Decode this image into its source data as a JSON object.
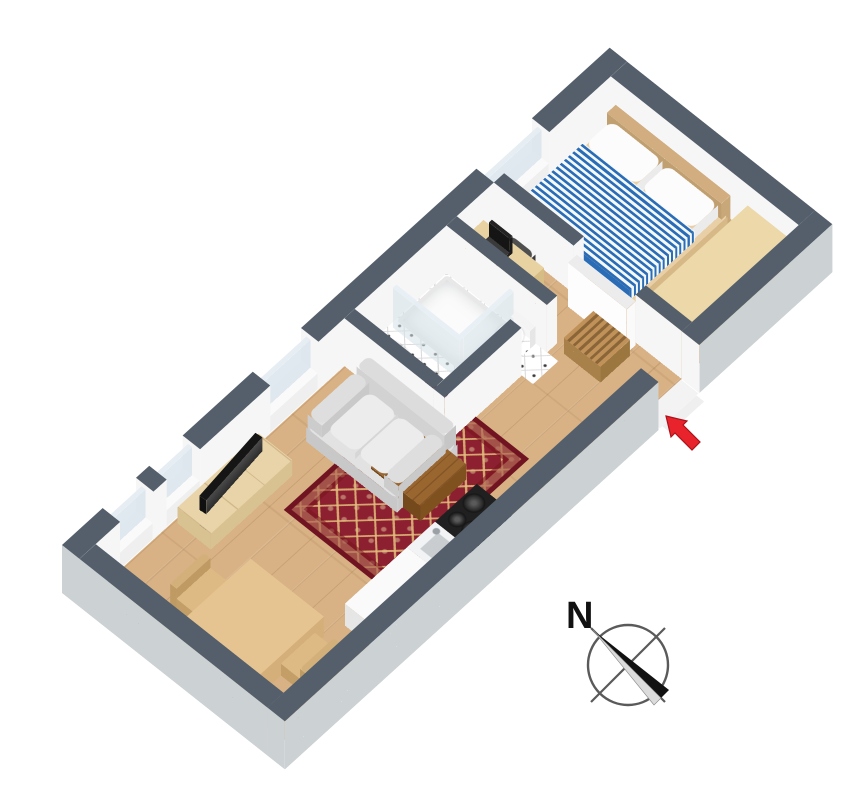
{
  "page": {
    "background": "#ffffff",
    "type": "3d-floor-plan-render"
  },
  "compass": {
    "label": "N",
    "icon": "compass-rose-icon",
    "needle_dark": "#111111",
    "needle_light": "#dcdcdc",
    "ring_color": "#5a5a5a"
  },
  "entrance": {
    "icon": "red-arrow-icon",
    "meaning": "entrance-marker",
    "color": "#e8232b"
  },
  "palette": {
    "wall_top": "#545f6b",
    "wall_side_interior": "#f6f6f6",
    "wall_side_exterior": "#ccd1d4",
    "floor_wood": "#d8b184",
    "tile_white": "#ffffff",
    "rug_red": "#8c2030",
    "rug_border": "#6f1420",
    "rug_gold": "#e2be7c",
    "bed_stripe_blue": "#2a6db6",
    "linen_white": "#f6f9fb",
    "wood_light": "#e8d4a8",
    "wood_mid": "#d9c291",
    "table_wood": "#e6c492",
    "coffee_table_brown": "#9a662f",
    "sofa_gray": "#e2e2e2",
    "counter_white": "#fafafa",
    "stove_black": "#202020",
    "steel_gray": "#c9cdd0",
    "glass_blue": "rgba(214,226,234,0.75)",
    "door_white": "#f1f1f1",
    "wardrobe_tan": "#ecd8a8",
    "headboard_wood": "#d2ad7f",
    "rack_wood": "#c09158",
    "desk_chair_gray": "#4f4f4f",
    "laptop_black": "#2b2b2b"
  },
  "rooms": [
    {
      "name": "living-room-kitchen",
      "furniture": [
        "sofa",
        "area-rug",
        "coffee-table",
        "tv",
        "tv-stand",
        "dining-table",
        "dining-chair",
        "dining-chair",
        "kitchen-counter",
        "kitchen-sink",
        "stove-cooktop"
      ]
    },
    {
      "name": "bathroom",
      "furniture": [
        "shower",
        "shower-glass",
        "washbasin",
        "toilet"
      ]
    },
    {
      "name": "hallway",
      "furniture": [
        "shoe-rack",
        "entrance-door"
      ]
    },
    {
      "name": "bedroom",
      "furniture": [
        "double-bed",
        "pillows",
        "headboard",
        "wardrobe-sideboard",
        "desk",
        "laptop",
        "desk-chair"
      ]
    }
  ]
}
